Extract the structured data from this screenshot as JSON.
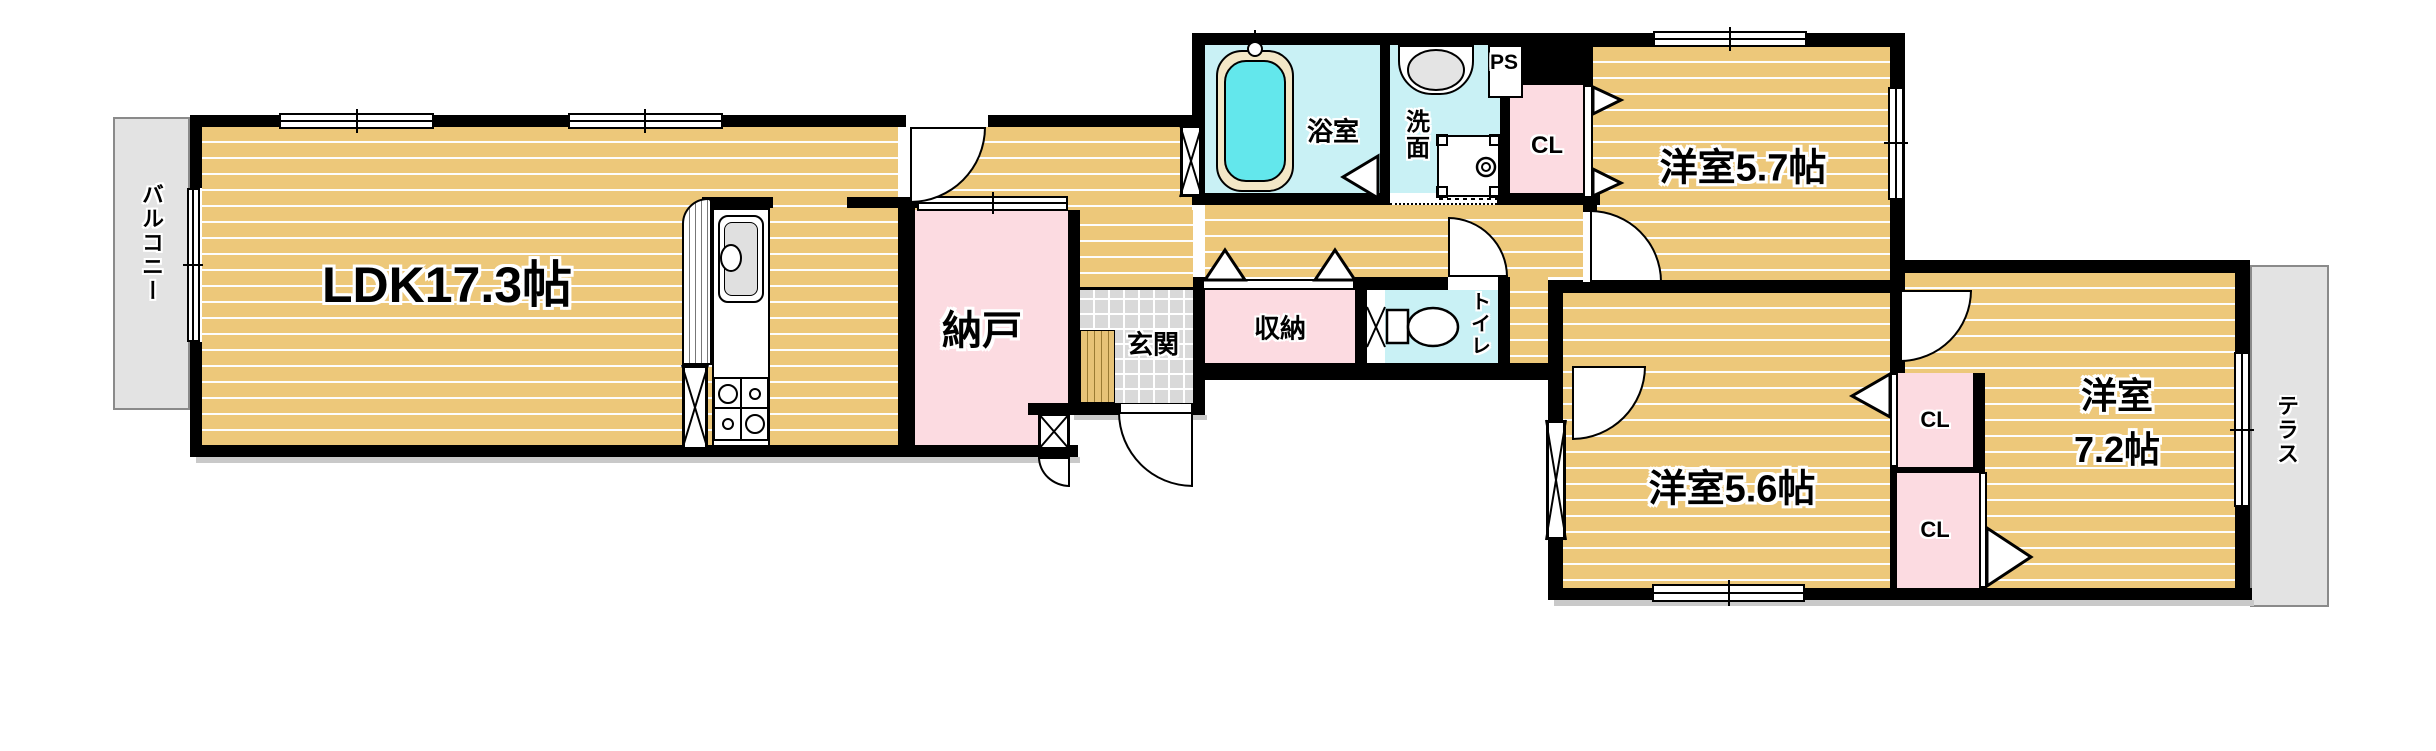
{
  "rooms": {
    "ldk": "LDK17.3帖",
    "nando": "納戸",
    "genkan": "玄関",
    "shuno": "収納",
    "bathroom": "浴室",
    "washroom": "洗面",
    "toilet": "トイレ",
    "ps": "PS",
    "cl_bath": "CL",
    "west57": "洋室5.7帖",
    "west56": "洋室5.6帖",
    "west72_l1": "洋室",
    "west72_l2": "7.2帖",
    "cl_56": "CL",
    "cl_72": "CL",
    "balcony": "バルコニー",
    "terrace": "テラス"
  },
  "colors": {
    "wall": "#000000",
    "floor_tan": "#edc87a",
    "closet_pink": "#fcdbe1",
    "wet_area_cyan": "#c9f1f5",
    "tub_water": "#63e7ec",
    "balcony_gray": "#e3e3e3",
    "entry_tile_gray": "#d9d9d9",
    "step_wood": "#e7c377"
  }
}
